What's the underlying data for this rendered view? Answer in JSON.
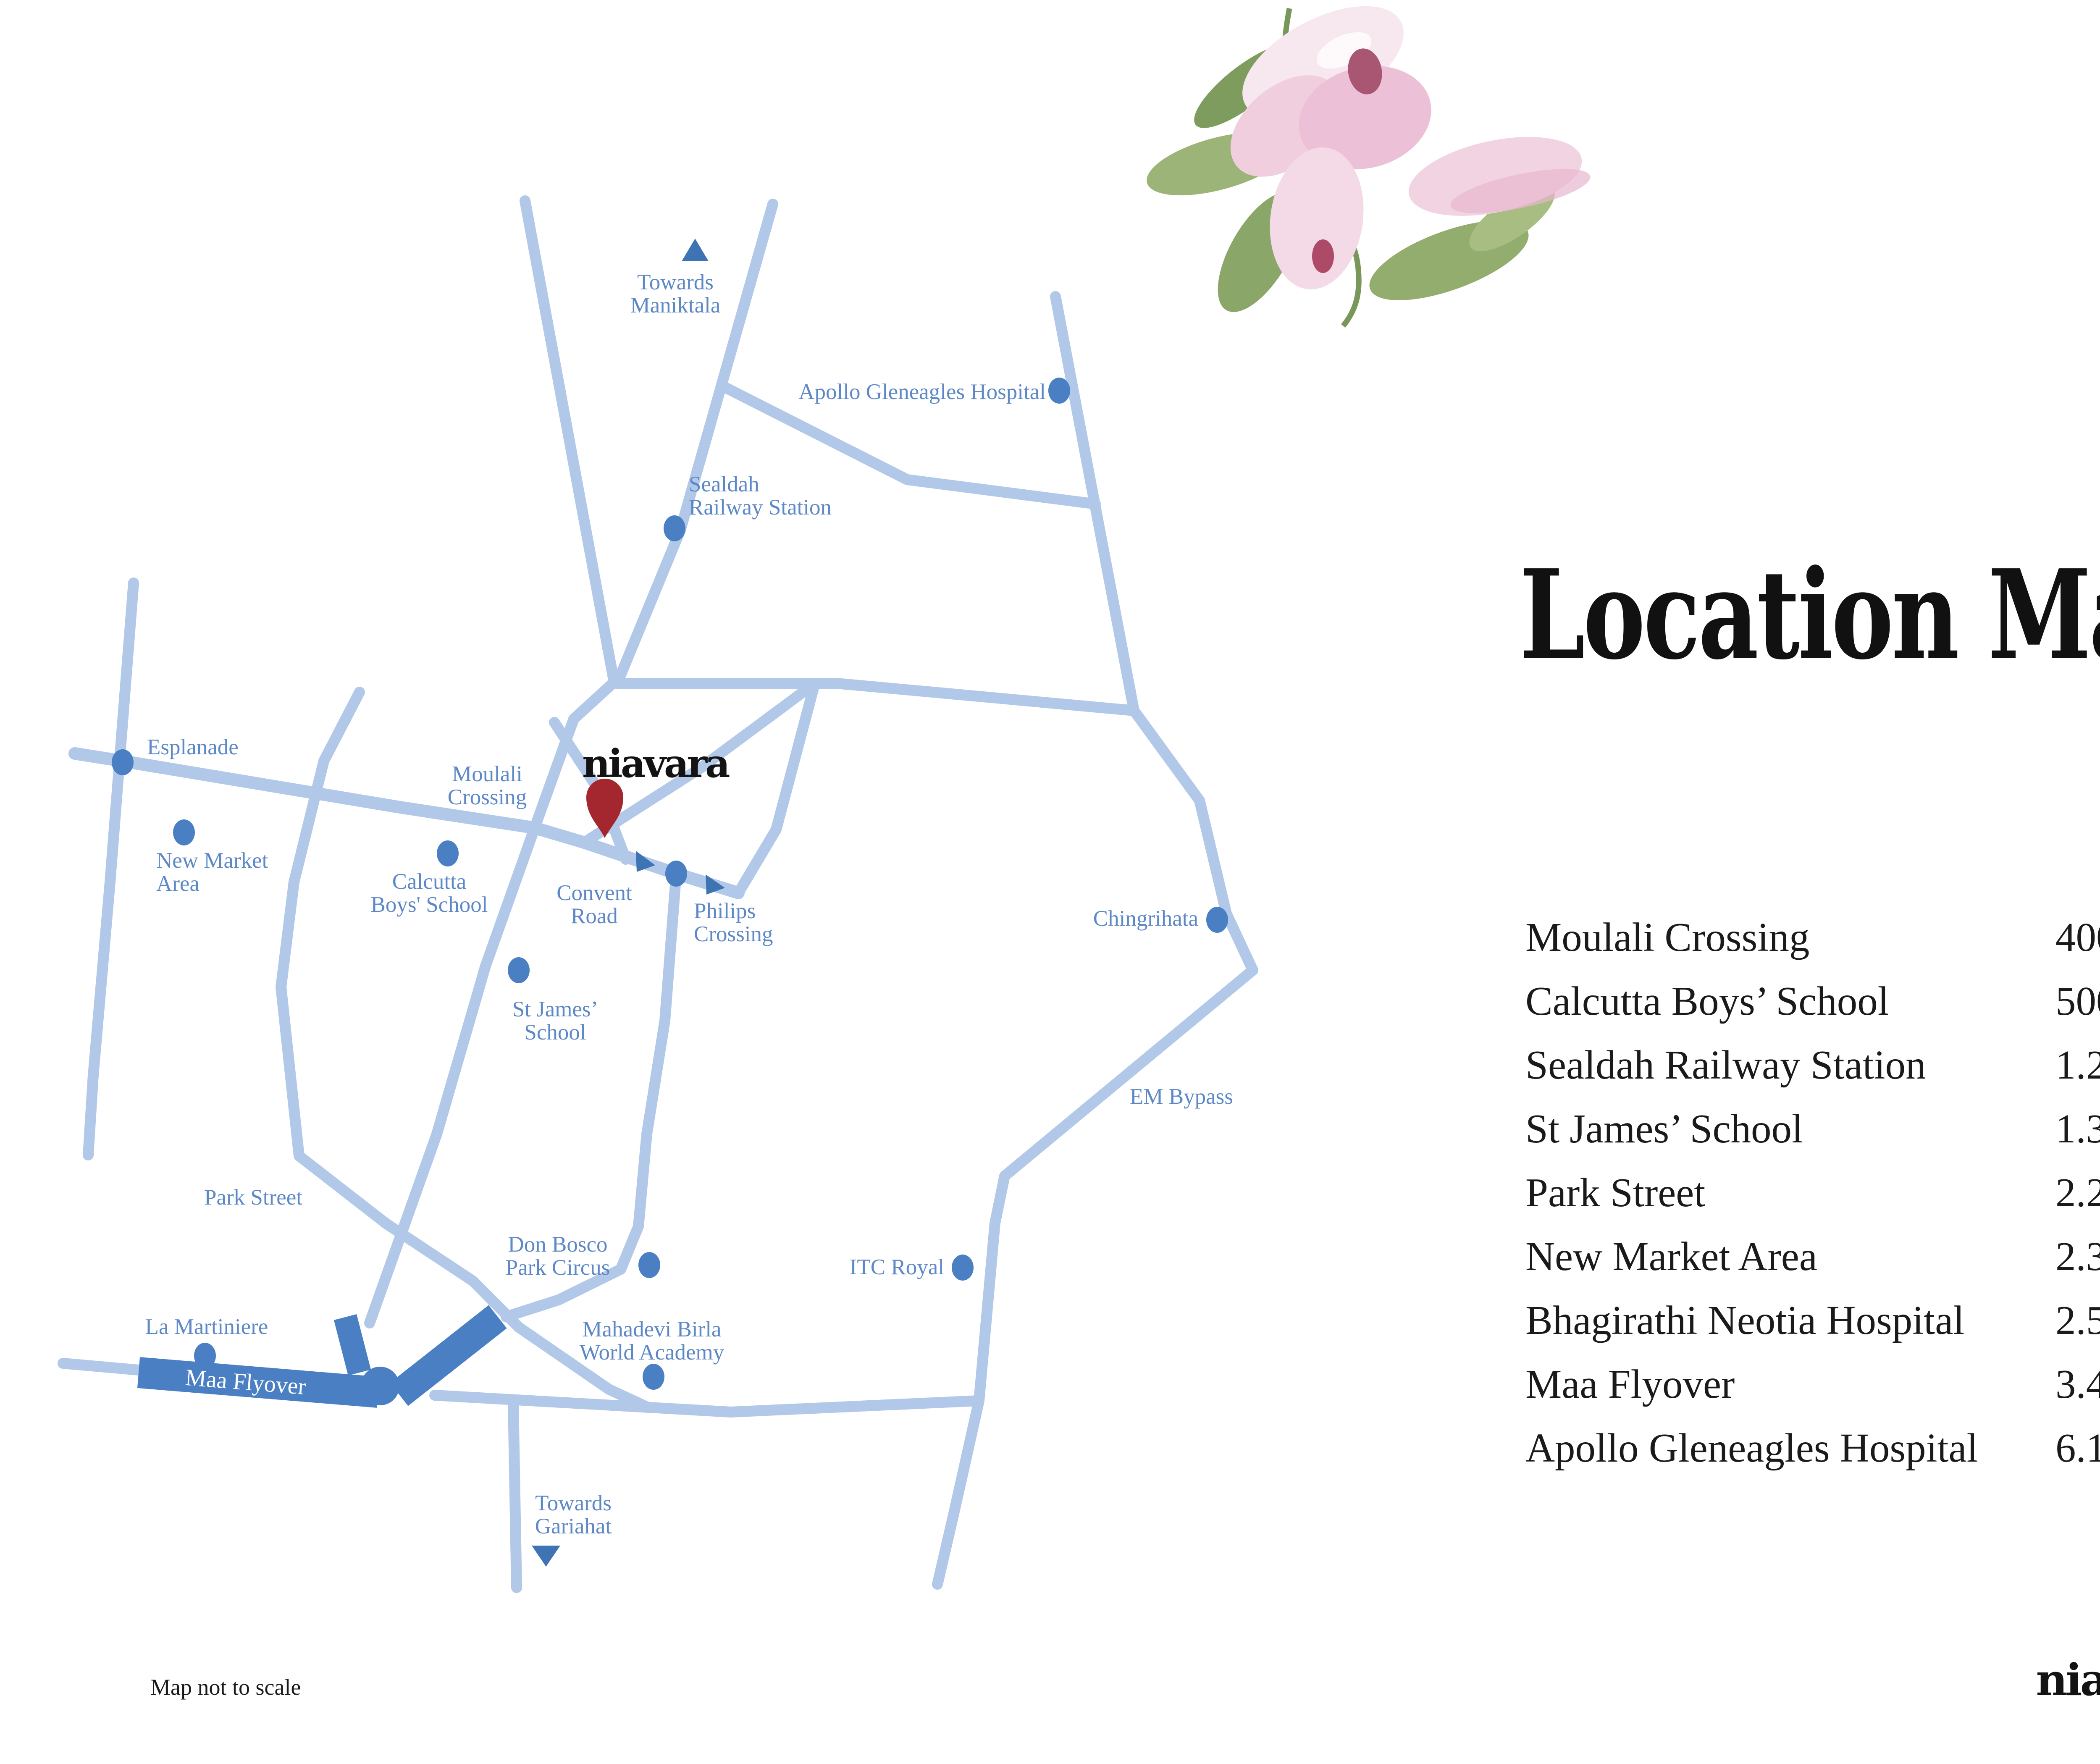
{
  "page": {
    "number": "Page 00",
    "title": "Location Map",
    "note": "Map not to scale",
    "brand": "niavara"
  },
  "colors": {
    "road_blue": "#b2c8e8",
    "accent_blue": "#4a80c3",
    "label_blue": "#5d88c6",
    "pin_red": "#a4262f",
    "ink": "#1a1a1a"
  },
  "map": {
    "brand_marker": "niavara",
    "labels": [
      {
        "id": "towards-maniktala",
        "text": "Towards\nManiktala"
      },
      {
        "id": "apollo-gleneagles-hospital",
        "text": "Apollo Gleneagles Hospital"
      },
      {
        "id": "sealdah-railway-station",
        "text": "Sealdah\nRailway Station"
      },
      {
        "id": "esplanade",
        "text": "Esplanade"
      },
      {
        "id": "new-market-area",
        "text": "New Market\nArea"
      },
      {
        "id": "moulali-crossing",
        "text": "Moulali\nCrossing"
      },
      {
        "id": "calcutta-boys-school",
        "text": "Calcutta\nBoys' School"
      },
      {
        "id": "convent-road",
        "text": "Convent\nRoad"
      },
      {
        "id": "philips-crossing",
        "text": "Philips\nCrossing"
      },
      {
        "id": "chingrihata",
        "text": "Chingrihata"
      },
      {
        "id": "st-james-school",
        "text": "St James’\nSchool"
      },
      {
        "id": "em-bypass",
        "text": "EM Bypass"
      },
      {
        "id": "park-street",
        "text": "Park Street"
      },
      {
        "id": "don-bosco-park-circus",
        "text": "Don Bosco\nPark Circus"
      },
      {
        "id": "itc-royal",
        "text": "ITC Royal"
      },
      {
        "id": "la-martiniere",
        "text": "La Martiniere"
      },
      {
        "id": "mahadevi-birla",
        "text": "Mahadevi Birla\nWorld Academy"
      },
      {
        "id": "maa-flyover",
        "text": "Maa Flyover"
      },
      {
        "id": "towards-gariahat",
        "text": "Towards\nGariahat"
      }
    ]
  },
  "distances": {
    "rows": [
      {
        "place": "Moulali Crossing",
        "distance": "400 m"
      },
      {
        "place": "Calcutta Boys’ School",
        "distance": "500 m"
      },
      {
        "place": "Sealdah Railway Station",
        "distance": "1.2 km"
      },
      {
        "place": "St James’ School",
        "distance": "1.3 km"
      },
      {
        "place": "Park Street",
        "distance": "2.2 km"
      },
      {
        "place": "New Market Area",
        "distance": "2.3 km"
      },
      {
        "place": "Bhagirathi Neotia Hospital",
        "distance": "2.5 km"
      },
      {
        "place": "Maa Flyover",
        "distance": "3.4 km"
      },
      {
        "place": "Apollo Gleneagles Hospital",
        "distance": "6.1 km"
      }
    ]
  }
}
